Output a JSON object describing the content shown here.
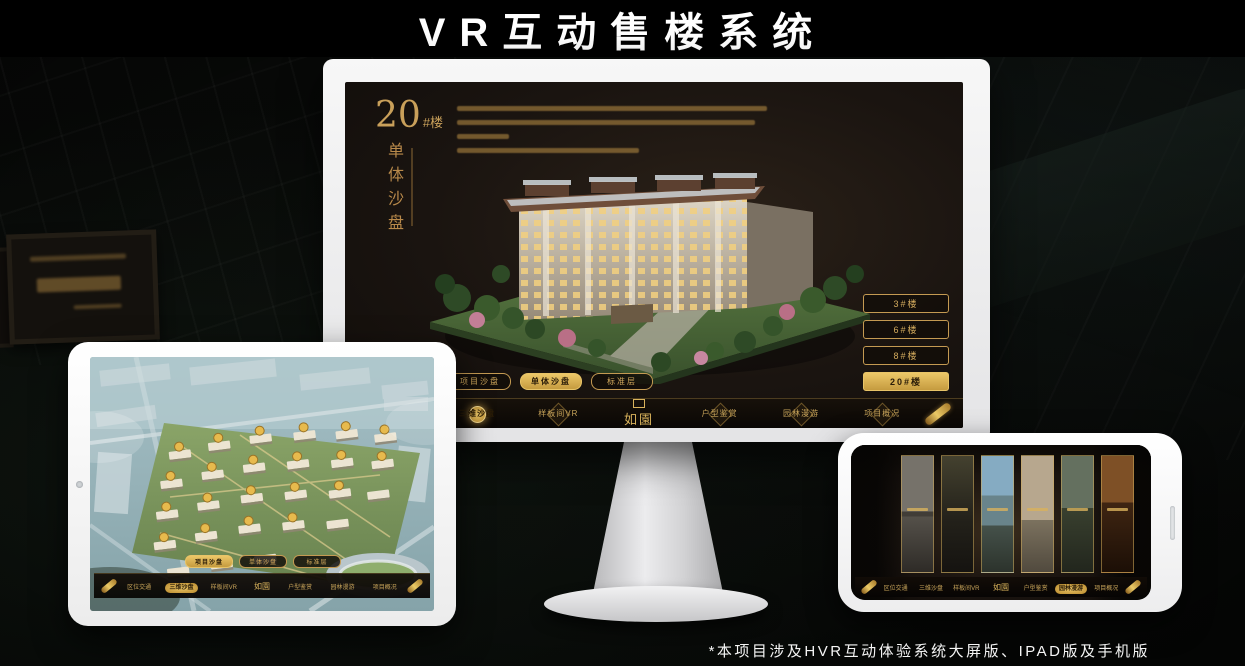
{
  "page": {
    "title": "VR互动售楼系统",
    "footnote": "*本项目涉及HVR互动体验系统大屏版、IPAD版及手机版"
  },
  "colors": {
    "accent_gold": "#c9a25c",
    "accent_gold_bright": "#ecc768",
    "screen_background": "#1a1410",
    "banner_background": "#000000"
  },
  "monitor": {
    "headline": {
      "number": "20",
      "suffix": "#楼",
      "subtitle": "单体沙盘"
    },
    "floor_buttons": [
      {
        "label": "3#楼",
        "active": false
      },
      {
        "label": "6#楼",
        "active": false
      },
      {
        "label": "8#楼",
        "active": false
      },
      {
        "label": "20#楼",
        "active": true
      }
    ],
    "subtabs": [
      {
        "label": "项目沙盘",
        "active": false
      },
      {
        "label": "单体沙盘",
        "active": true
      },
      {
        "label": "标准层",
        "active": false
      }
    ],
    "nav": {
      "logo": "如園",
      "items": [
        {
          "label": "区位交通",
          "active": false
        },
        {
          "label": "三维沙盘",
          "active": true
        },
        {
          "label": "样板间VR",
          "active": false
        },
        {
          "label": "户型鉴赏",
          "active": false
        },
        {
          "label": "园林漫游",
          "active": false
        },
        {
          "label": "项目概况",
          "active": false
        }
      ]
    }
  },
  "tablet": {
    "subtabs": [
      {
        "label": "项目沙盘",
        "active": true
      },
      {
        "label": "单体沙盘",
        "active": false
      },
      {
        "label": "标准层",
        "active": false
      }
    ],
    "nav": {
      "logo": "如園",
      "items": [
        {
          "label": "区位交通",
          "active": false
        },
        {
          "label": "三维沙盘",
          "active": true
        },
        {
          "label": "样板间VR",
          "active": false
        },
        {
          "label": "户型鉴赏",
          "active": false
        },
        {
          "label": "园林漫游",
          "active": false
        },
        {
          "label": "项目概况",
          "active": false
        }
      ]
    }
  },
  "phone": {
    "nav": {
      "logo": "如園",
      "items": [
        {
          "label": "区位交通",
          "active": false
        },
        {
          "label": "三维沙盘",
          "active": false
        },
        {
          "label": "样板间VR",
          "active": false
        },
        {
          "label": "户型鉴赏",
          "active": false
        },
        {
          "label": "园林漫游",
          "active": true
        },
        {
          "label": "项目概况",
          "active": false
        }
      ]
    },
    "gallery_panel_count": 6
  }
}
